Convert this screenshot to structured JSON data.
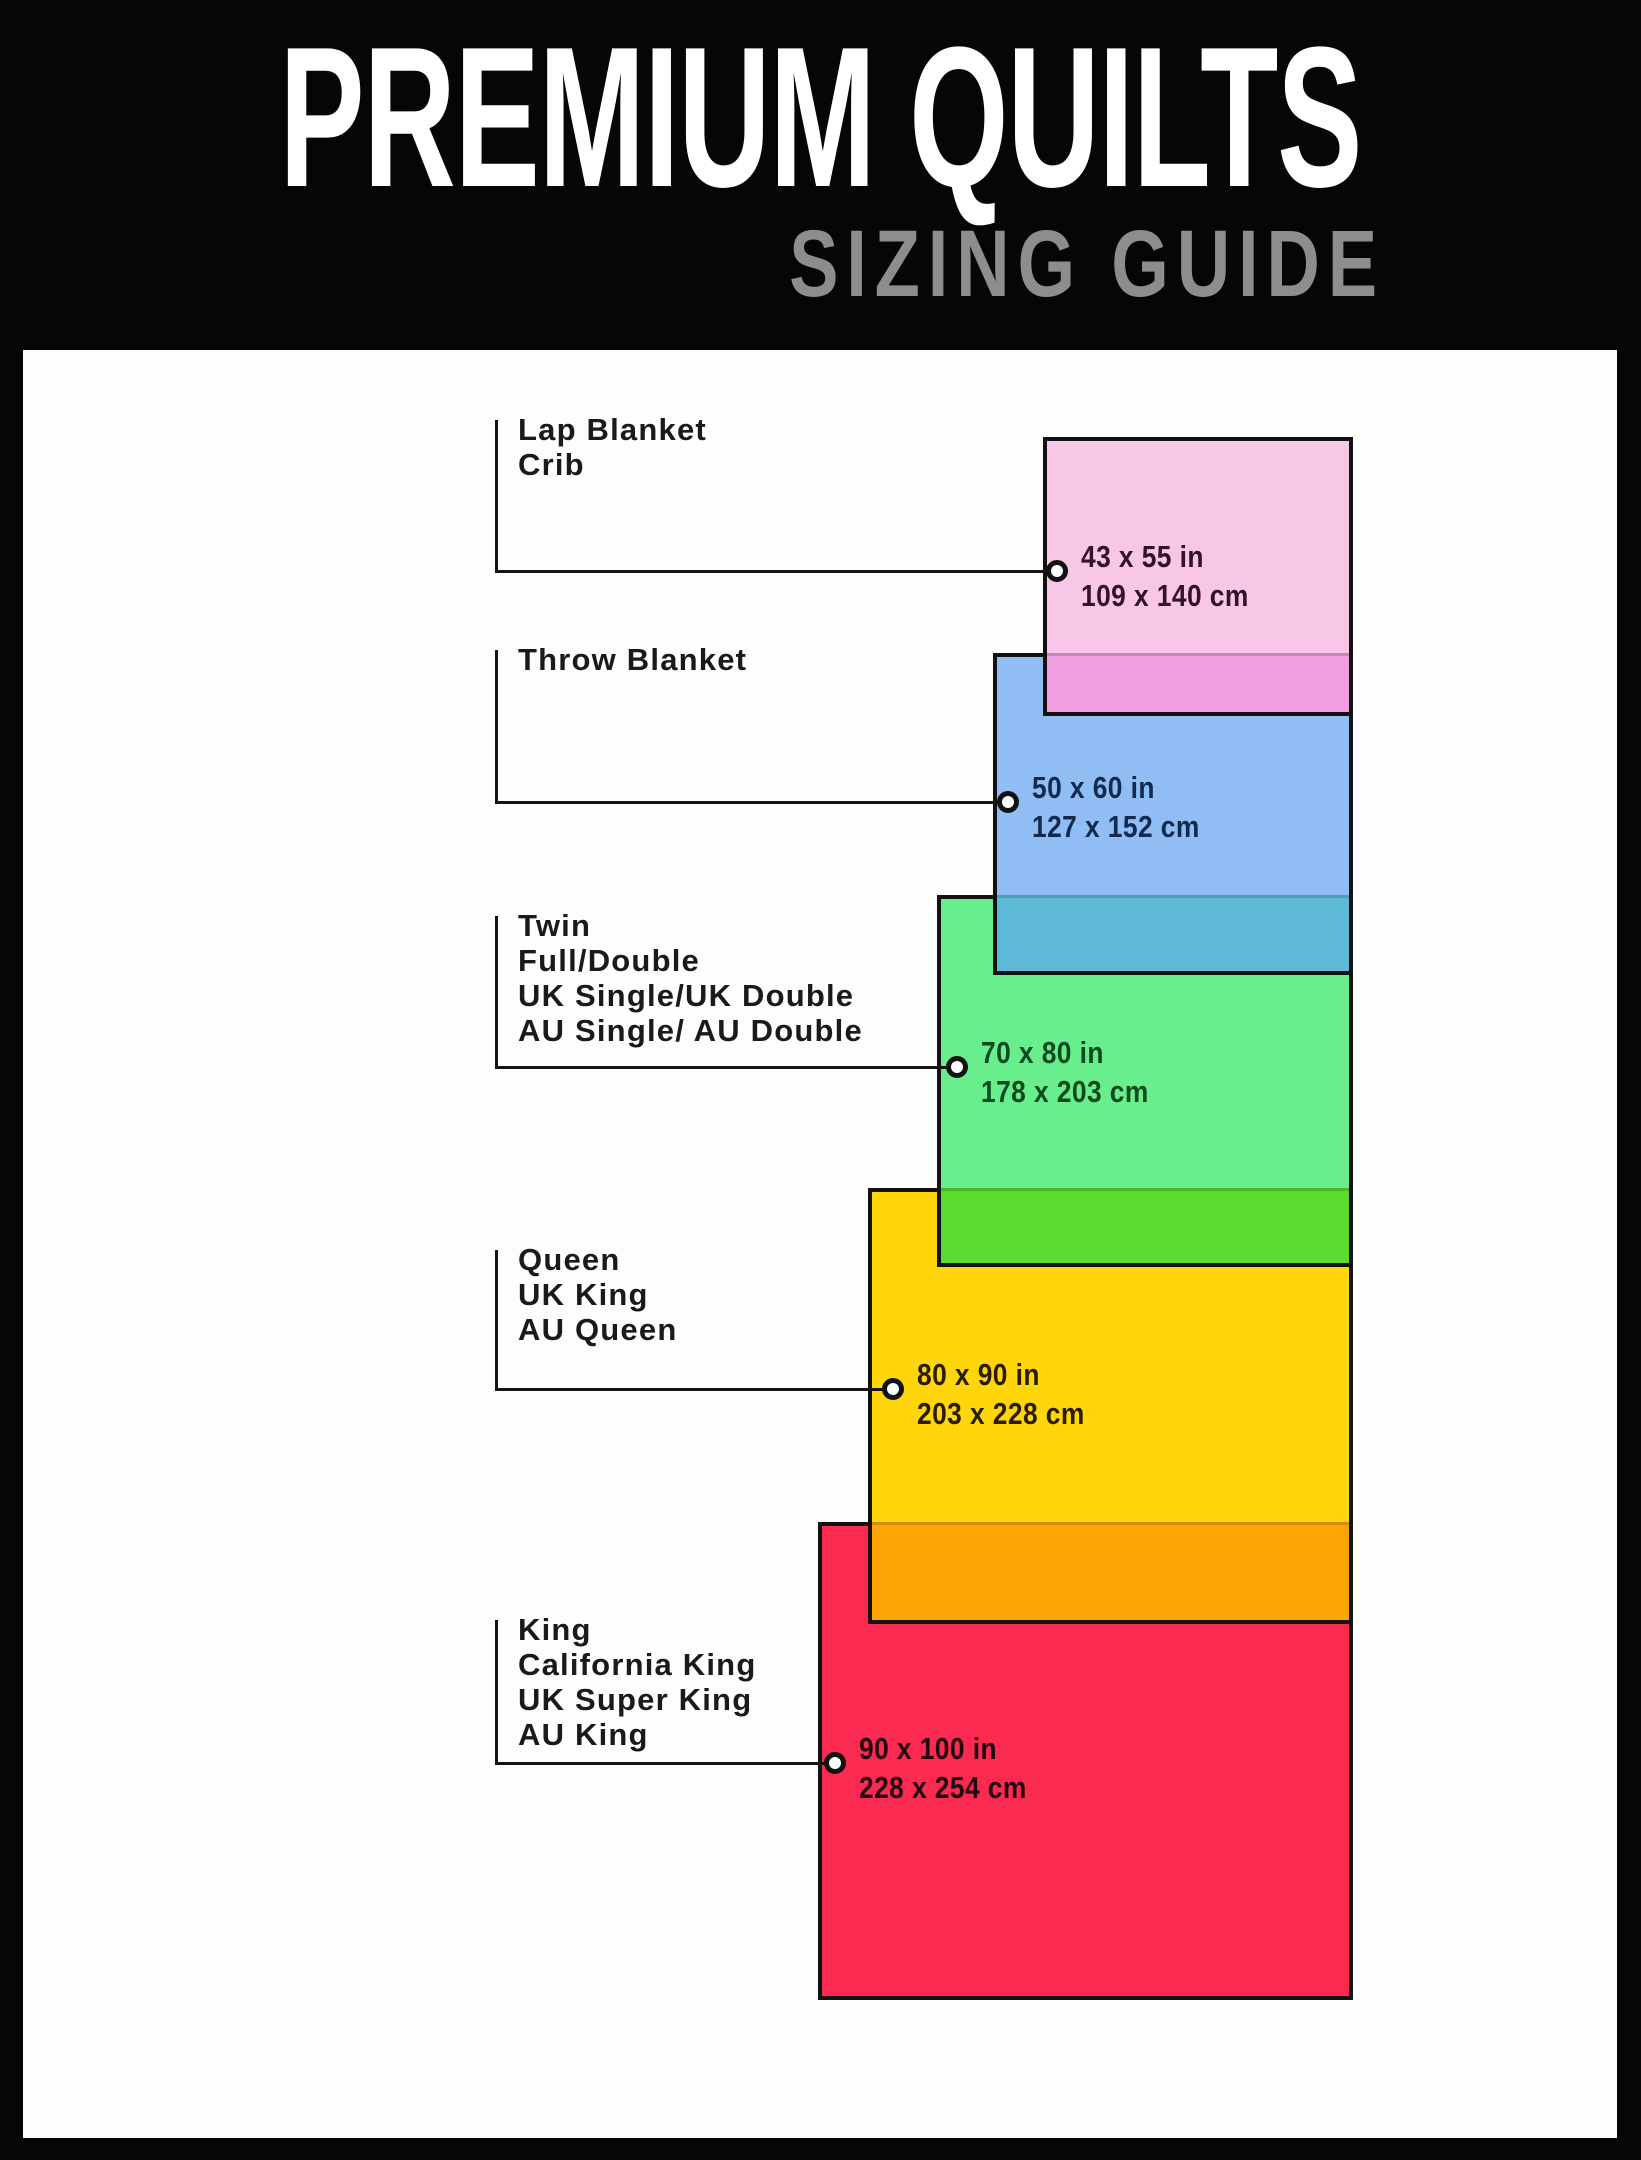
{
  "header": {
    "title": "PREMIUM QUILTS",
    "subtitle": "SIZING GUIDE",
    "title_color": "#ffffff",
    "subtitle_color": "#8d8d8d",
    "background": "#060606"
  },
  "canvas": {
    "width": 1641,
    "height": 2160,
    "frame_color": "#060606",
    "paper_color": "#fdfdfd"
  },
  "diagram": {
    "connector_color": "#141414",
    "spine_x": 497,
    "label_x": 518,
    "right_edge": 1353,
    "sizes": [
      {
        "id": "lap-blanket",
        "names": [
          "Lap Blanket",
          "Crib"
        ],
        "inches": "43 x 55 in",
        "cm": "109 x 140 cm",
        "fill": "#F8C6E6",
        "overlap_fill": "#EF9FE0",
        "dim_text_color": "#33122E",
        "rect": {
          "left": 1043,
          "top": 437,
          "bottom": 716
        },
        "band_from": 653,
        "label_top": 412,
        "line_y": 571,
        "dot_x": 1057
      },
      {
        "id": "throw-blanket",
        "names": [
          "Throw Blanket"
        ],
        "inches": "50 x 60 in",
        "cm": "127 x 152 cm",
        "fill": "#8FBDF4",
        "overlap_fill": "#5EB9D6",
        "dim_text_color": "#112A4E",
        "rect": {
          "left": 993,
          "top": 653,
          "bottom": 975
        },
        "band_from": 895,
        "label_top": 642,
        "line_y": 802,
        "dot_x": 1008
      },
      {
        "id": "twin",
        "names": [
          "Twin",
          "Full/Double",
          "UK Single/UK Double",
          "AU Single/ AU Double"
        ],
        "inches": "70 x 80 in",
        "cm": "178 x 203 cm",
        "fill": "#69EE8D",
        "overlap_fill": "#5DDA2E",
        "dim_text_color": "#0C4A20",
        "rect": {
          "left": 937,
          "top": 895,
          "bottom": 1267
        },
        "band_from": 1188,
        "label_top": 908,
        "line_y": 1067,
        "dot_x": 957
      },
      {
        "id": "queen",
        "names": [
          "Queen",
          "UK King",
          "AU Queen"
        ],
        "inches": "80 x 90 in",
        "cm": "203 x 228 cm",
        "fill": "#FFD60B",
        "overlap_fill": "#FFA407",
        "dim_text_color": "#2B1D02",
        "rect": {
          "left": 868,
          "top": 1188,
          "bottom": 1624
        },
        "band_from": 1522,
        "label_top": 1242,
        "line_y": 1389,
        "dot_x": 893
      },
      {
        "id": "king",
        "names": [
          "King",
          "California King",
          "UK Super King",
          "AU King"
        ],
        "inches": "90 x 100 in",
        "cm": "228 x 254 cm",
        "fill": "#FB2A50",
        "overlap_fill": null,
        "dim_text_color": "#230610",
        "rect": {
          "left": 818,
          "top": 1522,
          "bottom": 2000
        },
        "band_from": null,
        "label_top": 1612,
        "line_y": 1763,
        "dot_x": 835
      }
    ]
  }
}
